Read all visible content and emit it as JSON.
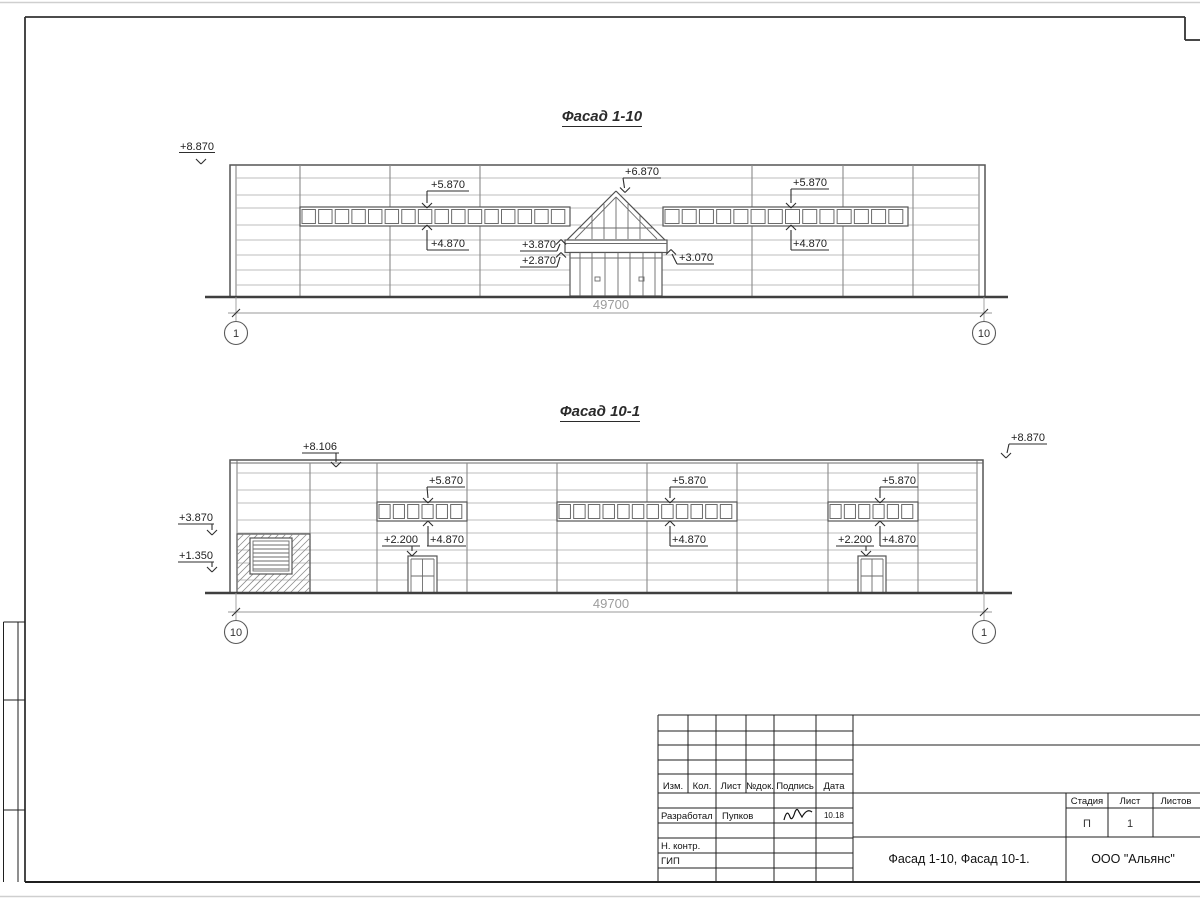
{
  "sheet": {
    "facades": {
      "f1": {
        "title": "Фасад 1-10",
        "dimension": "49700",
        "axis_left": "1",
        "axis_right": "10",
        "marks": {
          "top_left": "+8.870",
          "band_left_top": "+5.870",
          "band_left_bottom": "+4.870",
          "roof_peak": "+6.870",
          "band_right_top": "+5.870",
          "band_right_bottom": "+4.870",
          "canopy_top": "+3.870",
          "canopy_bottom": "+2.870",
          "canopy_right": "+3.070"
        }
      },
      "f2": {
        "title": "Фасад 10-1",
        "dimension": "49700",
        "axis_left": "10",
        "axis_right": "1",
        "marks": {
          "parapet_left": "+8.106",
          "top_right": "+8.870",
          "block_top": "+3.870",
          "block_bottom": "+1.350",
          "band1_top": "+5.870",
          "band1_bottom": "+4.870",
          "door1_top": "+2.200",
          "band2_top": "+5.870",
          "band2_bottom": "+4.870",
          "band3_top": "+5.870",
          "band3_bottom": "+4.870",
          "door2_top": "+2.200"
        }
      }
    },
    "title_block": {
      "col_izm": "Изм.",
      "col_kol": "Кол.",
      "col_list": "Лист",
      "col_ndoc": "№док.",
      "col_podpis": "Подпись",
      "col_data": "Дата",
      "row_developed": "Разработал",
      "developer": "Пупков",
      "date": "10.18",
      "row_ncontr": "Н. контр.",
      "row_gip": "ГИП",
      "doc_title": "Фасад 1-10, Фасад 10-1.",
      "company": "ООО \"Альянс\"",
      "stage_label": "Стадия",
      "sheet_label": "Лист",
      "sheets_label": "Листов",
      "stage": "П",
      "sheet_no": "1"
    }
  }
}
